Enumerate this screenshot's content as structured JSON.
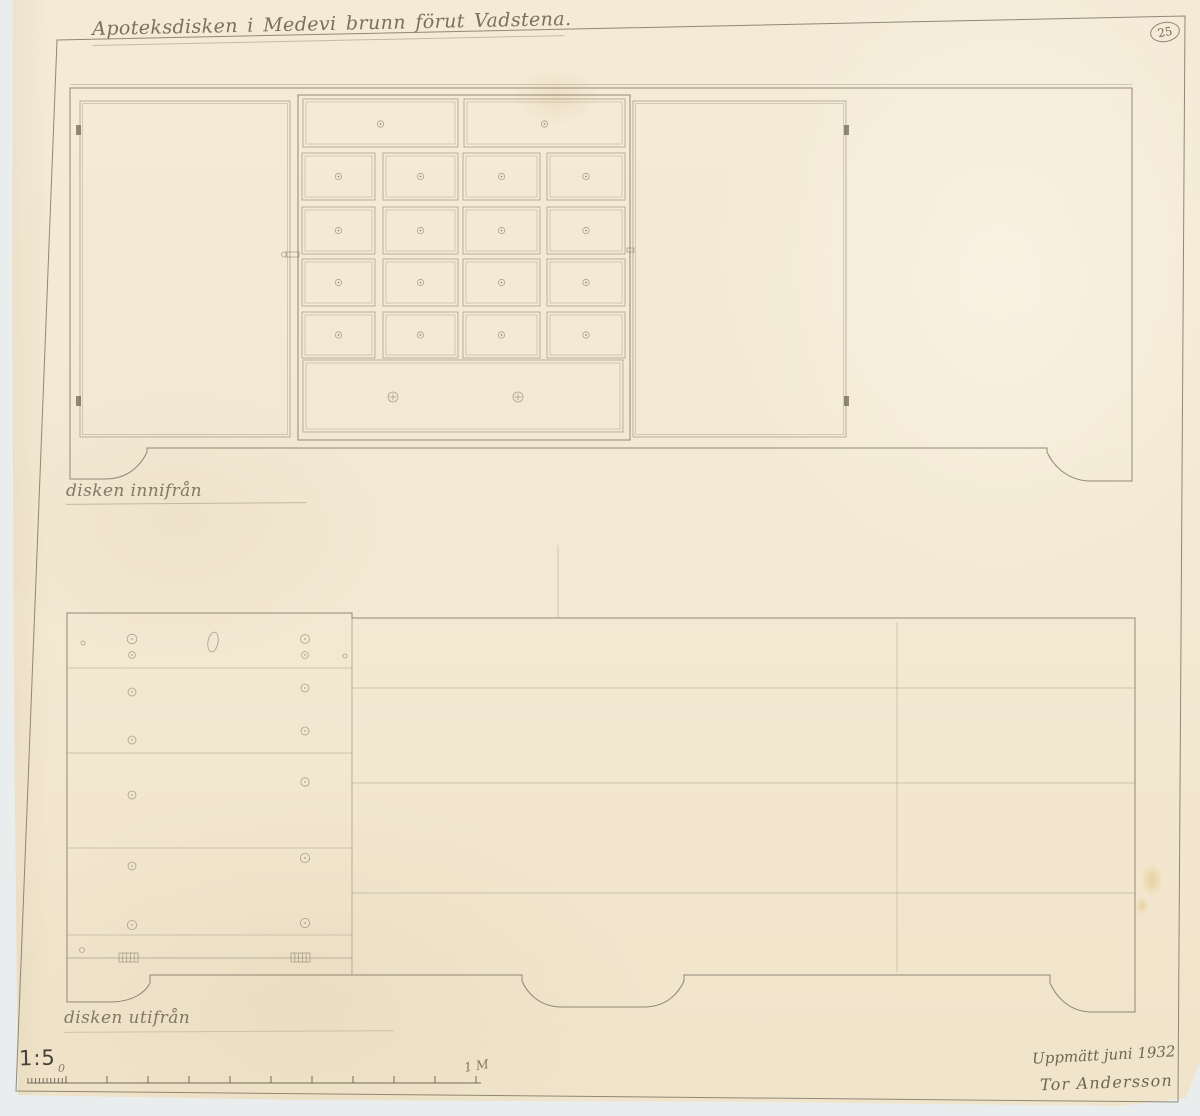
{
  "sheet": {
    "title": "Apoteksdisken i Medevi brunn förut Vadstena.",
    "sheet_number": "25",
    "label_inside": "disken innifrån",
    "label_outside": "disken utifrån",
    "scale_label": "1:5",
    "ruler_zero_label": "0",
    "ruler_meter_label": "1 M",
    "measured_note": "Uppmätt juni 1932",
    "signature": "Tor Andersson"
  },
  "colors": {
    "paper": "#f4e9d4",
    "background": "#e9edee",
    "pencil": "#8a8170",
    "pencil_dark": "#5d5749",
    "handwriting": "#6e6753"
  },
  "border": {
    "path": "M57,40 L1185,16 L1178,1102 L16,1091 Z"
  },
  "top_drawing": {
    "outline": "M70,88 L1132,88 L1132,481 L1091,481 C1064,481 1051,461 1047,452 L1047,448 L147,448 L147,452 C143,461 131,479 106,479 L70,479 Z",
    "top_edge_y": 84.5,
    "doors": [
      {
        "x": 80,
        "y": 101,
        "w": 210,
        "h": 336
      },
      {
        "x": 633,
        "y": 101,
        "w": 213,
        "h": 336
      }
    ],
    "hinge_w": 5,
    "hinge_h": 10,
    "hinges": [
      {
        "x": 76,
        "y": 125
      },
      {
        "x": 76,
        "y": 396
      },
      {
        "x": 844,
        "y": 125
      },
      {
        "x": 844,
        "y": 396
      }
    ],
    "latches": [
      {
        "x": 286,
        "y": 252,
        "w": 13,
        "h": 5
      },
      {
        "x": 627,
        "y": 248,
        "w": 7,
        "h": 4
      }
    ],
    "frame": {
      "x": 298,
      "y": 95,
      "w": 332,
      "h": 345
    },
    "knob_r": 3.2,
    "top_row": {
      "y": 99,
      "h": 48,
      "knob_y": 124,
      "drawers": [
        {
          "x": 303,
          "w": 155
        },
        {
          "x": 464,
          "w": 161
        }
      ]
    },
    "cols": [
      {
        "x": 302,
        "w": 73
      },
      {
        "x": 383,
        "w": 75
      },
      {
        "x": 463,
        "w": 77
      },
      {
        "x": 547,
        "w": 78
      }
    ],
    "rows": [
      {
        "y": 153,
        "h": 47
      },
      {
        "y": 207,
        "h": 47
      },
      {
        "y": 259,
        "h": 47
      },
      {
        "y": 312,
        "h": 46
      }
    ],
    "bottom_drawer": {
      "x": 303,
      "y": 360,
      "w": 320,
      "h": 72,
      "knob_y": 397,
      "knobs": [
        393,
        518
      ],
      "knob_r": 5
    }
  },
  "bottom_drawing": {
    "outline": "M67,613 L352,613 L352,618 L1135,618 L1135,1012 L1092,1012 C1066,1012 1054,992 1050,983 L1050,975 L684,975 L684,981 C680,990 669,1007 644,1007 L562,1007 C537,1007 526,990 522,981 L522,975 L150,975 L150,983 C146,991 135,1002 109,1002 L67,1002 Z",
    "divider": {
      "x": 352,
      "y1": 613,
      "y2": 975
    },
    "left_planks": {
      "x1": 67,
      "x2": 352,
      "ys": [
        668,
        753,
        848,
        935
      ]
    },
    "rail": {
      "x1": 67,
      "x2": 352,
      "y": 958
    },
    "right_planks": {
      "x1": 352,
      "x2": 1135,
      "ys": [
        688,
        783,
        893
      ]
    },
    "hatch_w": 19,
    "hatch_h": 9,
    "hinge_hatches": [
      {
        "x": 119,
        "y": 953
      },
      {
        "x": 291,
        "y": 953
      }
    ],
    "nails": [
      [
        132,
        639,
        4.8
      ],
      [
        132,
        655,
        3.4
      ],
      [
        132,
        692,
        4
      ],
      [
        132,
        740,
        4
      ],
      [
        132,
        795,
        4
      ],
      [
        132,
        866,
        4
      ],
      [
        132,
        925,
        4.6
      ],
      [
        305,
        639,
        4.4
      ],
      [
        305,
        655,
        3.4
      ],
      [
        305,
        688,
        4
      ],
      [
        305,
        731,
        4
      ],
      [
        305,
        782,
        4.2
      ],
      [
        305,
        858,
        4.6
      ],
      [
        305,
        923,
        4.6
      ],
      [
        83,
        643,
        2
      ],
      [
        82,
        950,
        2.4
      ],
      [
        345,
        656,
        2
      ]
    ],
    "keyhole": {
      "cx": 213,
      "cy": 642,
      "rx": 5,
      "ry": 10,
      "rot": 10
    },
    "crease": {
      "x": 897,
      "y1": 622,
      "y2": 972
    }
  },
  "ruler": {
    "baseline": {
      "x1": 27,
      "x2": 481,
      "y": 1083
    },
    "fine": {
      "x1": 28,
      "x2": 66,
      "count": 11,
      "tick_h": 5
    },
    "major": {
      "x0": 66,
      "step": 41,
      "count": 11,
      "tick_h": 7
    }
  },
  "creases": [
    {
      "x": 558,
      "y1": 545,
      "y2": 618
    }
  ],
  "underlines": {
    "inside": {
      "left": 66,
      "top": 503,
      "width": 240
    },
    "outside": {
      "left": 64,
      "top": 1031,
      "width": 330
    }
  }
}
